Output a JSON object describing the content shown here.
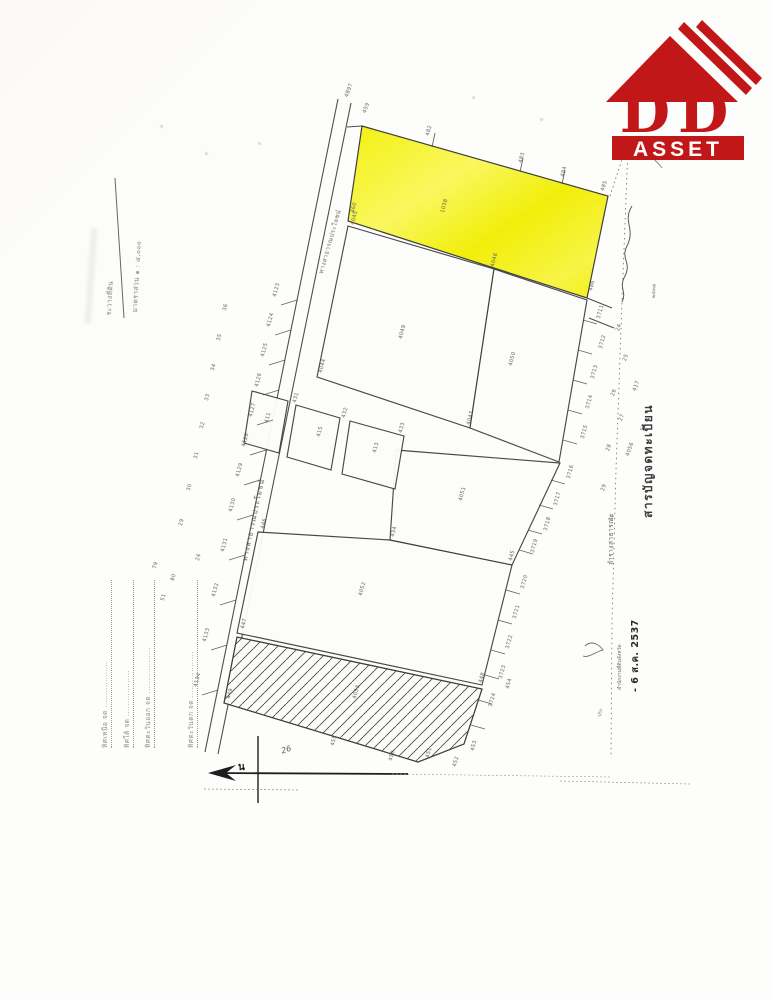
{
  "logo": {
    "dd": "DD",
    "asset": "ASSET",
    "url": "www.ddasset.co.th"
  },
  "colors": {
    "logo_red": "#c21718",
    "parcel_yellow": "#f5f116",
    "map_line": "#3f3f3f"
  },
  "texts": {
    "registry_index": "สารบัญจดทะเบียน",
    "road_name": "ทางสาธารณประโยชน์",
    "road_name_upper": "ทางสาธารณประโยชน์",
    "canal": "ลำรางสาธารณะ",
    "survey_sheet": "ระวางที่ดิน",
    "scale": "มาตราส่วน ๑ : ๔,๐๐๐",
    "stamp_office": "สำนักงานที่ดินจังหวัด",
    "stamp_date": "- 6 ส.ค. 2537",
    "stamp_year": "๒๕๓๗",
    "compass_north": "น",
    "handwritten_note": "26",
    "margin_note": "ประ"
  },
  "boundary_lines": [
    "ทิศเหนือ จด ..................",
    "ทิศใต้ จด ..................",
    "ทิศตะวันออก จด ..................",
    "ทิศตะวันตก จด .................."
  ],
  "map": {
    "formline_x": [
      100,
      122,
      143,
      186
    ],
    "parcel_labels": [
      [
        440,
        212,
        -75,
        "1038"
      ],
      [
        398,
        338,
        -75,
        "4049"
      ],
      [
        508,
        365,
        -75,
        "4050"
      ],
      [
        458,
        500,
        -75,
        "4051"
      ],
      [
        358,
        595,
        -75,
        "4052"
      ],
      [
        352,
        698,
        -75,
        "4053"
      ],
      [
        264,
        422,
        -75,
        "411"
      ],
      [
        316,
        436,
        -75,
        "415"
      ],
      [
        372,
        452,
        -75,
        "413"
      ]
    ],
    "stakes": [
      [
        272,
        296,
        -75,
        "4123"
      ],
      [
        266,
        326,
        -75,
        "4124"
      ],
      [
        260,
        356,
        -75,
        "4125"
      ],
      [
        254,
        386,
        -75,
        "4126"
      ],
      [
        248,
        416,
        -75,
        "4127"
      ],
      [
        241,
        446,
        -75,
        "4128"
      ],
      [
        235,
        476,
        -75,
        "4129"
      ],
      [
        228,
        511,
        -75,
        "4130"
      ],
      [
        220,
        551,
        -75,
        "4131"
      ],
      [
        211,
        596,
        -75,
        "4132"
      ],
      [
        202,
        641,
        -75,
        "4133"
      ],
      [
        193,
        686,
        -75,
        "4134"
      ],
      [
        222,
        310,
        -75,
        "36"
      ],
      [
        216,
        340,
        -75,
        "35"
      ],
      [
        210,
        370,
        -75,
        "34"
      ],
      [
        204,
        400,
        -75,
        "33"
      ],
      [
        199,
        428,
        -75,
        "32"
      ],
      [
        193,
        458,
        -75,
        "31"
      ],
      [
        186,
        490,
        -75,
        "30"
      ],
      [
        178,
        525,
        -75,
        "29"
      ],
      [
        425,
        135,
        -75,
        "482"
      ],
      [
        518,
        162,
        -75,
        "483"
      ],
      [
        560,
        176,
        -75,
        "484"
      ],
      [
        600,
        190,
        -72,
        "485"
      ],
      [
        344,
        96,
        -70,
        "4897"
      ],
      [
        362,
        112,
        -70,
        "459"
      ],
      [
        350,
        212,
        -75,
        "460"
      ],
      [
        588,
        290,
        -75,
        "486"
      ],
      [
        596,
        318,
        -75,
        "3711"
      ],
      [
        598,
        348,
        -75,
        "3712"
      ],
      [
        590,
        378,
        -75,
        "3713"
      ],
      [
        585,
        408,
        -75,
        "3714"
      ],
      [
        580,
        438,
        -75,
        "3715"
      ],
      [
        566,
        478,
        -75,
        "3716"
      ],
      [
        553,
        505,
        -75,
        "3717"
      ],
      [
        543,
        530,
        -75,
        "3718"
      ],
      [
        530,
        552,
        -75,
        "3719"
      ],
      [
        520,
        588,
        -75,
        "3720"
      ],
      [
        512,
        618,
        -75,
        "3721"
      ],
      [
        505,
        648,
        -75,
        "3722"
      ],
      [
        498,
        678,
        -75,
        "3723"
      ],
      [
        488,
        706,
        -75,
        "3724"
      ],
      [
        615,
        330,
        -70,
        "24"
      ],
      [
        622,
        360,
        -70,
        "25"
      ],
      [
        610,
        395,
        -70,
        "26"
      ],
      [
        618,
        420,
        -70,
        "27"
      ],
      [
        605,
        450,
        -70,
        "28"
      ],
      [
        625,
        455,
        -70,
        "4056"
      ],
      [
        600,
        490,
        -70,
        "29"
      ],
      [
        632,
        390,
        -70,
        "417"
      ],
      [
        640,
        430,
        -70,
        "57"
      ],
      [
        608,
        520,
        -70,
        "30"
      ],
      [
        350,
        224,
        -75,
        "4045"
      ],
      [
        490,
        266,
        -75,
        "4046"
      ],
      [
        466,
        424,
        -75,
        "4047"
      ],
      [
        318,
        372,
        -75,
        "4044"
      ],
      [
        292,
        402,
        -75,
        "431"
      ],
      [
        341,
        417,
        -75,
        "432"
      ],
      [
        398,
        432,
        -75,
        "433"
      ],
      [
        390,
        536,
        -75,
        "434"
      ],
      [
        508,
        560,
        -75,
        "445"
      ],
      [
        260,
        528,
        -75,
        "446"
      ],
      [
        240,
        628,
        -75,
        "447"
      ],
      [
        478,
        682,
        -75,
        "448"
      ],
      [
        226,
        698,
        -75,
        "449"
      ],
      [
        388,
        760,
        -75,
        "450"
      ],
      [
        425,
        757,
        -75,
        "451"
      ],
      [
        452,
        766,
        -75,
        "452"
      ],
      [
        470,
        750,
        -75,
        "453"
      ],
      [
        505,
        688,
        -75,
        "454"
      ],
      [
        330,
        745,
        -75,
        "455"
      ],
      [
        152,
        568,
        -75,
        "79"
      ],
      [
        170,
        580,
        -75,
        "80"
      ],
      [
        195,
        560,
        -75,
        "24"
      ],
      [
        160,
        600,
        -75,
        "51"
      ]
    ],
    "ticks": {
      "road": [
        [
          297,
          300
        ],
        [
          291,
          330
        ],
        [
          285,
          360
        ],
        [
          279,
          390
        ],
        [
          273,
          420
        ],
        [
          266,
          450
        ],
        [
          260,
          480
        ],
        [
          253,
          515
        ],
        [
          245,
          555
        ],
        [
          236,
          600
        ],
        [
          227,
          645
        ],
        [
          218,
          690
        ]
      ],
      "right": [
        [
          583,
          320
        ],
        [
          578,
          350
        ],
        [
          573,
          380
        ],
        [
          568,
          410
        ],
        [
          563,
          440
        ],
        [
          551,
          480
        ],
        [
          539,
          505
        ],
        [
          528,
          530
        ],
        [
          519,
          550
        ],
        [
          506,
          590
        ],
        [
          498,
          620
        ],
        [
          491,
          650
        ],
        [
          485,
          675
        ],
        [
          478,
          700
        ],
        [
          471,
          725
        ]
      ],
      "top": [
        [
          432,
          147
        ],
        [
          520,
          172
        ],
        [
          562,
          184
        ]
      ]
    }
  }
}
